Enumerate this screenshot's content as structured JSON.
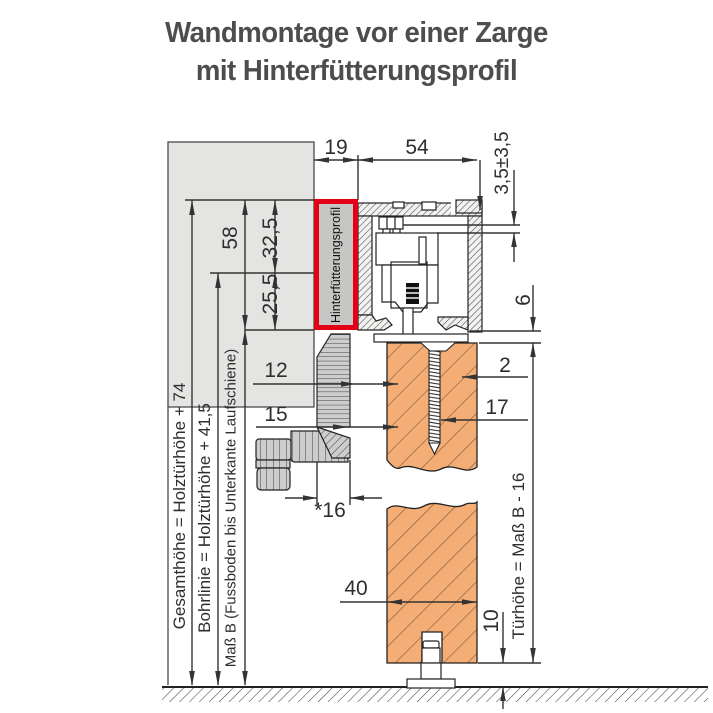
{
  "title": {
    "line1": "Wandmontage vor einer Zarge",
    "line2": "mit Hinterfütterungsprofil"
  },
  "diagram": {
    "highlight_label": "Hinterfütterungsprofil",
    "dimensions": {
      "top_offset": "19",
      "track_width": "54",
      "height_adjustment": "3,5±3,5",
      "profile_height": "58",
      "upper_section": "32,5",
      "lower_section": "25,5",
      "clearance_track_door": "6",
      "gap_twelve": "12",
      "gap_fifteen": "15",
      "gap_two": "2",
      "screw_length": "17",
      "frame_depth": "*16",
      "door_thickness": "40",
      "floor_clearance": "10"
    },
    "vertical_labels": {
      "gesamthoehe": "Gesamthöhe = Holztürhöhe + 74",
      "bohrlinie": "Bohrlinie = Holztürhöhe + 41,5",
      "mass_b": "Maß B (Fussboden bis Unterkante Laufschiene)",
      "tuerhoehe": "Türhöhe = Maß B - 16"
    },
    "colors": {
      "highlight_red": "#e10016",
      "wood_orange": "#f4ae75",
      "wall_gray": "#e4e4e3",
      "frame_gray": "#cdcdcd",
      "line": "#333333"
    }
  }
}
